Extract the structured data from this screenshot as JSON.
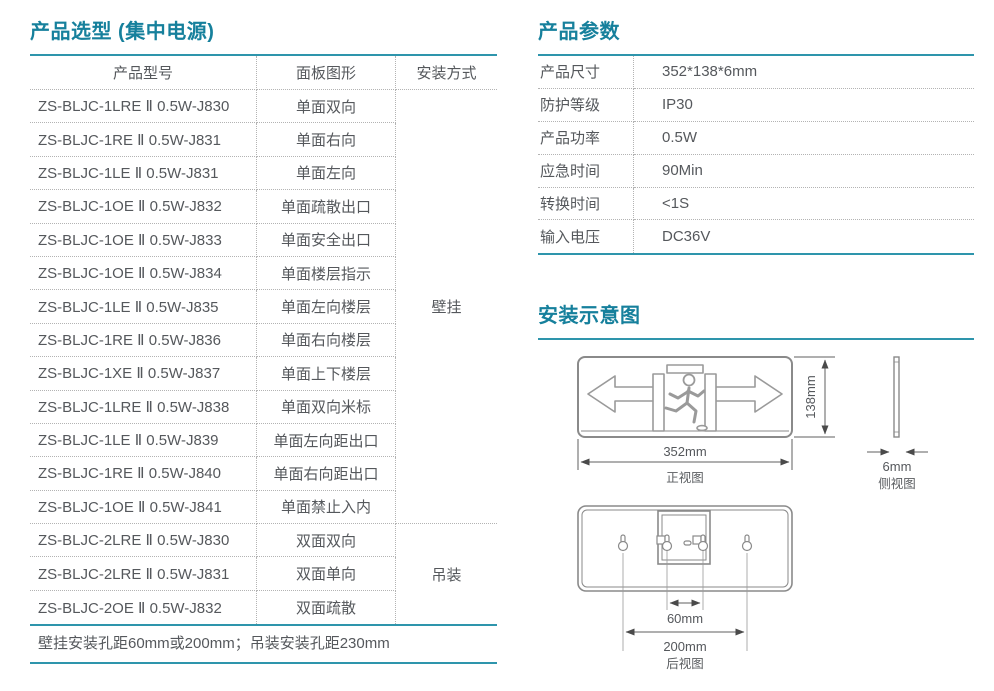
{
  "colors": {
    "accent_text": "#16809c",
    "accent_line": "#2e95ac",
    "body_text": "#55585c"
  },
  "selection": {
    "title": "产品选型 (集中电源)",
    "columns": [
      "产品型号",
      "面板图形",
      "安装方式"
    ],
    "rows": [
      {
        "model": "ZS-BLJC-1LRE Ⅱ 0.5W-J830",
        "panel": "单面双向"
      },
      {
        "model": "ZS-BLJC-1RE Ⅱ 0.5W-J831",
        "panel": "单面右向"
      },
      {
        "model": "ZS-BLJC-1LE Ⅱ 0.5W-J831",
        "panel": "单面左向"
      },
      {
        "model": "ZS-BLJC-1OE Ⅱ 0.5W-J832",
        "panel": "单面疏散出口"
      },
      {
        "model": "ZS-BLJC-1OE Ⅱ 0.5W-J833",
        "panel": "单面安全出口"
      },
      {
        "model": "ZS-BLJC-1OE Ⅱ 0.5W-J834",
        "panel": "单面楼层指示"
      },
      {
        "model": "ZS-BLJC-1LE Ⅱ 0.5W-J835",
        "panel": "单面左向楼层"
      },
      {
        "model": "ZS-BLJC-1RE Ⅱ 0.5W-J836",
        "panel": "单面右向楼层"
      },
      {
        "model": "ZS-BLJC-1XE Ⅱ 0.5W-J837",
        "panel": "单面上下楼层"
      },
      {
        "model": "ZS-BLJC-1LRE Ⅱ 0.5W-J838",
        "panel": "单面双向米标"
      },
      {
        "model": "ZS-BLJC-1LE Ⅱ 0.5W-J839",
        "panel": "单面左向距出口"
      },
      {
        "model": "ZS-BLJC-1RE Ⅱ 0.5W-J840",
        "panel": "单面右向距出口"
      },
      {
        "model": "ZS-BLJC-1OE Ⅱ 0.5W-J841",
        "panel": "单面禁止入内"
      },
      {
        "model": "ZS-BLJC-2LRE Ⅱ 0.5W-J830",
        "panel": "双面双向"
      },
      {
        "model": "ZS-BLJC-2LRE Ⅱ 0.5W-J831",
        "panel": "双面单向"
      },
      {
        "model": "ZS-BLJC-2OE Ⅱ 0.5W-J832",
        "panel": "双面疏散"
      }
    ],
    "mount_groups": [
      {
        "label": "壁挂",
        "span": 13
      },
      {
        "label": "吊装",
        "span": 3
      }
    ],
    "footnote": "壁挂安装孔距60mm或200mm；吊装安装孔距230mm"
  },
  "parameters": {
    "title": "产品参数",
    "rows": [
      {
        "label": "产品尺寸",
        "value": "352*138*6mm"
      },
      {
        "label": "防护等级",
        "value": "IP30"
      },
      {
        "label": "产品功率",
        "value": "0.5W"
      },
      {
        "label": "应急时间",
        "value": "90Min"
      },
      {
        "label": "转换时间",
        "value": "<1S"
      },
      {
        "label": "输入电压",
        "value": "DC36V"
      }
    ]
  },
  "installation": {
    "title": "安装示意图",
    "front_view": {
      "label": "正视图",
      "width": "352mm",
      "height": "138mm"
    },
    "side_view": {
      "label": "侧视图",
      "thickness": "6mm"
    },
    "rear_view": {
      "label": "后视图",
      "inner_hole_pitch": "60mm",
      "outer_hole_pitch": "200mm"
    }
  }
}
